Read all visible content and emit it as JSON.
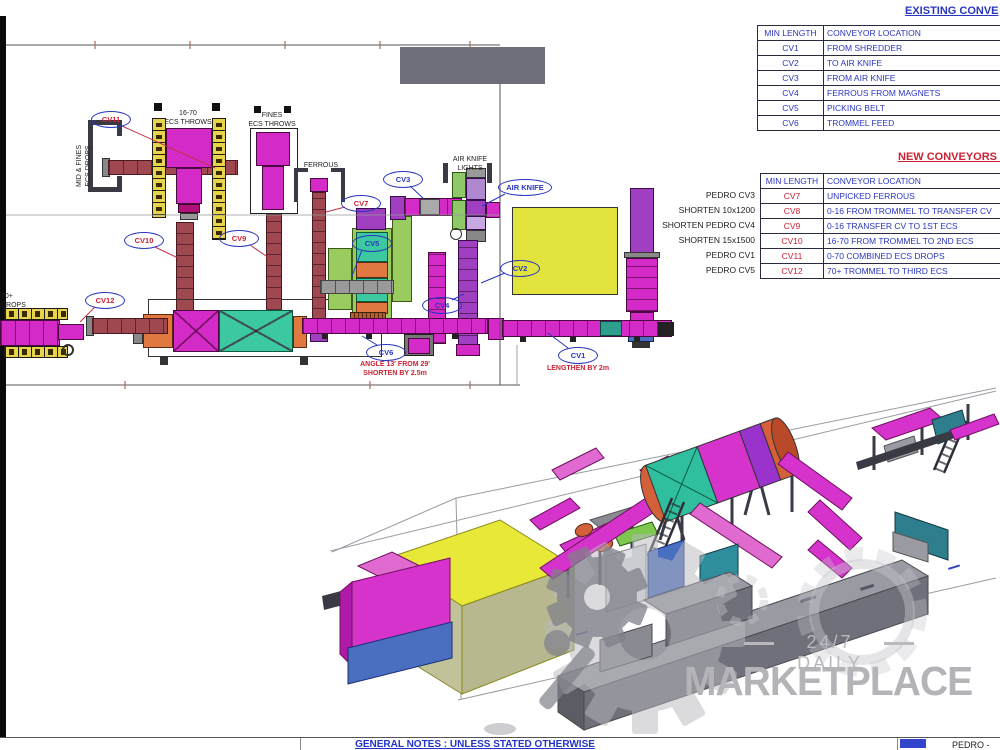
{
  "tables": {
    "existing": {
      "title": "EXISTING CONVE",
      "headers": [
        "MIN LENGTH",
        "CONVEYOR LOCATION"
      ],
      "rows": [
        [
          "CV1",
          "FROM SHREDDER"
        ],
        [
          "CV2",
          "TO AIR KNIFE"
        ],
        [
          "CV3",
          "FROM AIR KNIFE"
        ],
        [
          "CV4",
          "FERROUS FROM MAGNETS"
        ],
        [
          "CV5",
          "PICKING BELT"
        ],
        [
          "CV6",
          "TROMMEL FEED"
        ]
      ]
    },
    "new": {
      "title": "NEW CONVEYORS F",
      "headers": [
        "MIN LENGTH",
        "CONVEYOR LOCATION"
      ],
      "rows": [
        [
          "CV7",
          "UNPICKED FERROUS"
        ],
        [
          "CV8",
          "0-16 FROM TROMMEL TO TRANSFER CV"
        ],
        [
          "CV9",
          "0-16 TRANSFER CV TO 1ST ECS"
        ],
        [
          "CV10",
          "16-70 FROM TROMMEL TO 2ND ECS"
        ],
        [
          "CV11",
          "0-70 COMBINED ECS DROPS"
        ],
        [
          "CV12",
          "70+ TROMMEL TO THIRD ECS"
        ]
      ],
      "notes": [
        "PEDRO CV3",
        "SHORTEN 10x1200",
        "SHORTEN PEDRO CV4",
        "SHORTEN 15x1500",
        "PEDRO CV1",
        "PEDRO CV5"
      ]
    }
  },
  "plan": {
    "callouts": [
      {
        "label": "CV11",
        "type": "new"
      },
      {
        "label": "CV10",
        "type": "new"
      },
      {
        "label": "CV9",
        "type": "new"
      },
      {
        "label": "CV7",
        "type": "new"
      },
      {
        "label": "CV5",
        "type": "exist"
      },
      {
        "label": "CV3",
        "type": "exist"
      },
      {
        "label": "AIR KNIFE",
        "type": "exist"
      },
      {
        "label": "CV2",
        "type": "exist"
      },
      {
        "label": "CV4",
        "type": "exist"
      },
      {
        "label": "CV6",
        "type": "exist"
      },
      {
        "label": "CV1",
        "type": "exist"
      },
      {
        "label": "CV12",
        "type": "new"
      }
    ],
    "texts": {
      "ecs1": "16-70\nECS THROWS",
      "ecs2": "FINES\nECS THROWS",
      "bunker": "MID & FINES\nECS DROPS",
      "ferrous": "FERROUS",
      "airknife_lights": "AIR KNIFE\nLIGHTS",
      "drops70": "70+\nDROPS"
    },
    "notes": {
      "cv6": "ANGLE 13' FROM 29'\nSHORTEN BY 2.5m",
      "cv1": "LENGTHEN BY 2m"
    }
  },
  "watermark": {
    "line1": "24/7 DAILY",
    "line2": "MARKETPLACE"
  },
  "footer": {
    "notes": "GENERAL NOTES : UNLESS STATED OTHERWISE",
    "right": "PEDRO -"
  },
  "colors": {
    "table_blue": "#2936c0",
    "table_red": "#cc2233",
    "conveyor_magenta": "#d42bc8",
    "conveyor_darkred": "#a04850",
    "purple": "#a040c0",
    "yellow_blocks": "#e8d44a",
    "building_yellow": "#e3e33e",
    "teal": "#3cc8a0",
    "green": "#9acb5e",
    "orange": "#e07840",
    "watermark_gray": "#b4b4b8"
  }
}
